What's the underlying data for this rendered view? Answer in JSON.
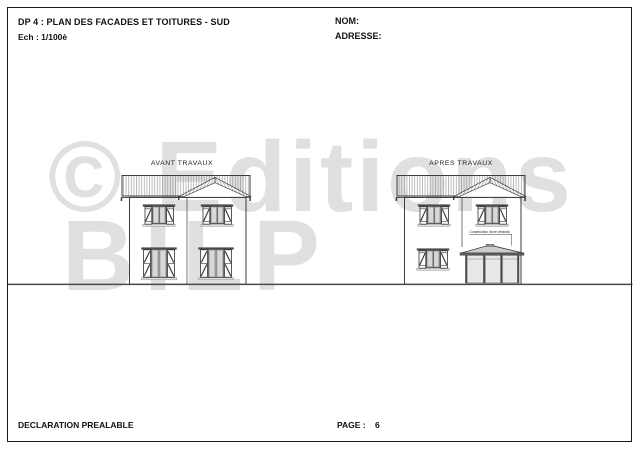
{
  "header": {
    "title": "DP 4 : PLAN DES FACADES ET TOITURES - SUD",
    "scale": "Ech : 1/100è",
    "name_label": "NOM:",
    "address_label": "ADRESSE:"
  },
  "drawing": {
    "before_label": "AVANT TRAVAUX",
    "after_label": "APRES TRAVAUX",
    "veranda_annotation": "Construction d'une véranda"
  },
  "watermark": {
    "line1": "© Editions",
    "line2": "BILP"
  },
  "footer": {
    "doc_type": "DECLARATION PREALABLE",
    "page_label": "PAGE :",
    "page_number": "6"
  },
  "colors": {
    "line": "#3d3d3d",
    "glazing": "#d8d8d8",
    "veranda_roof": "#cdcdcd",
    "watermark": "#e0e0e0"
  }
}
